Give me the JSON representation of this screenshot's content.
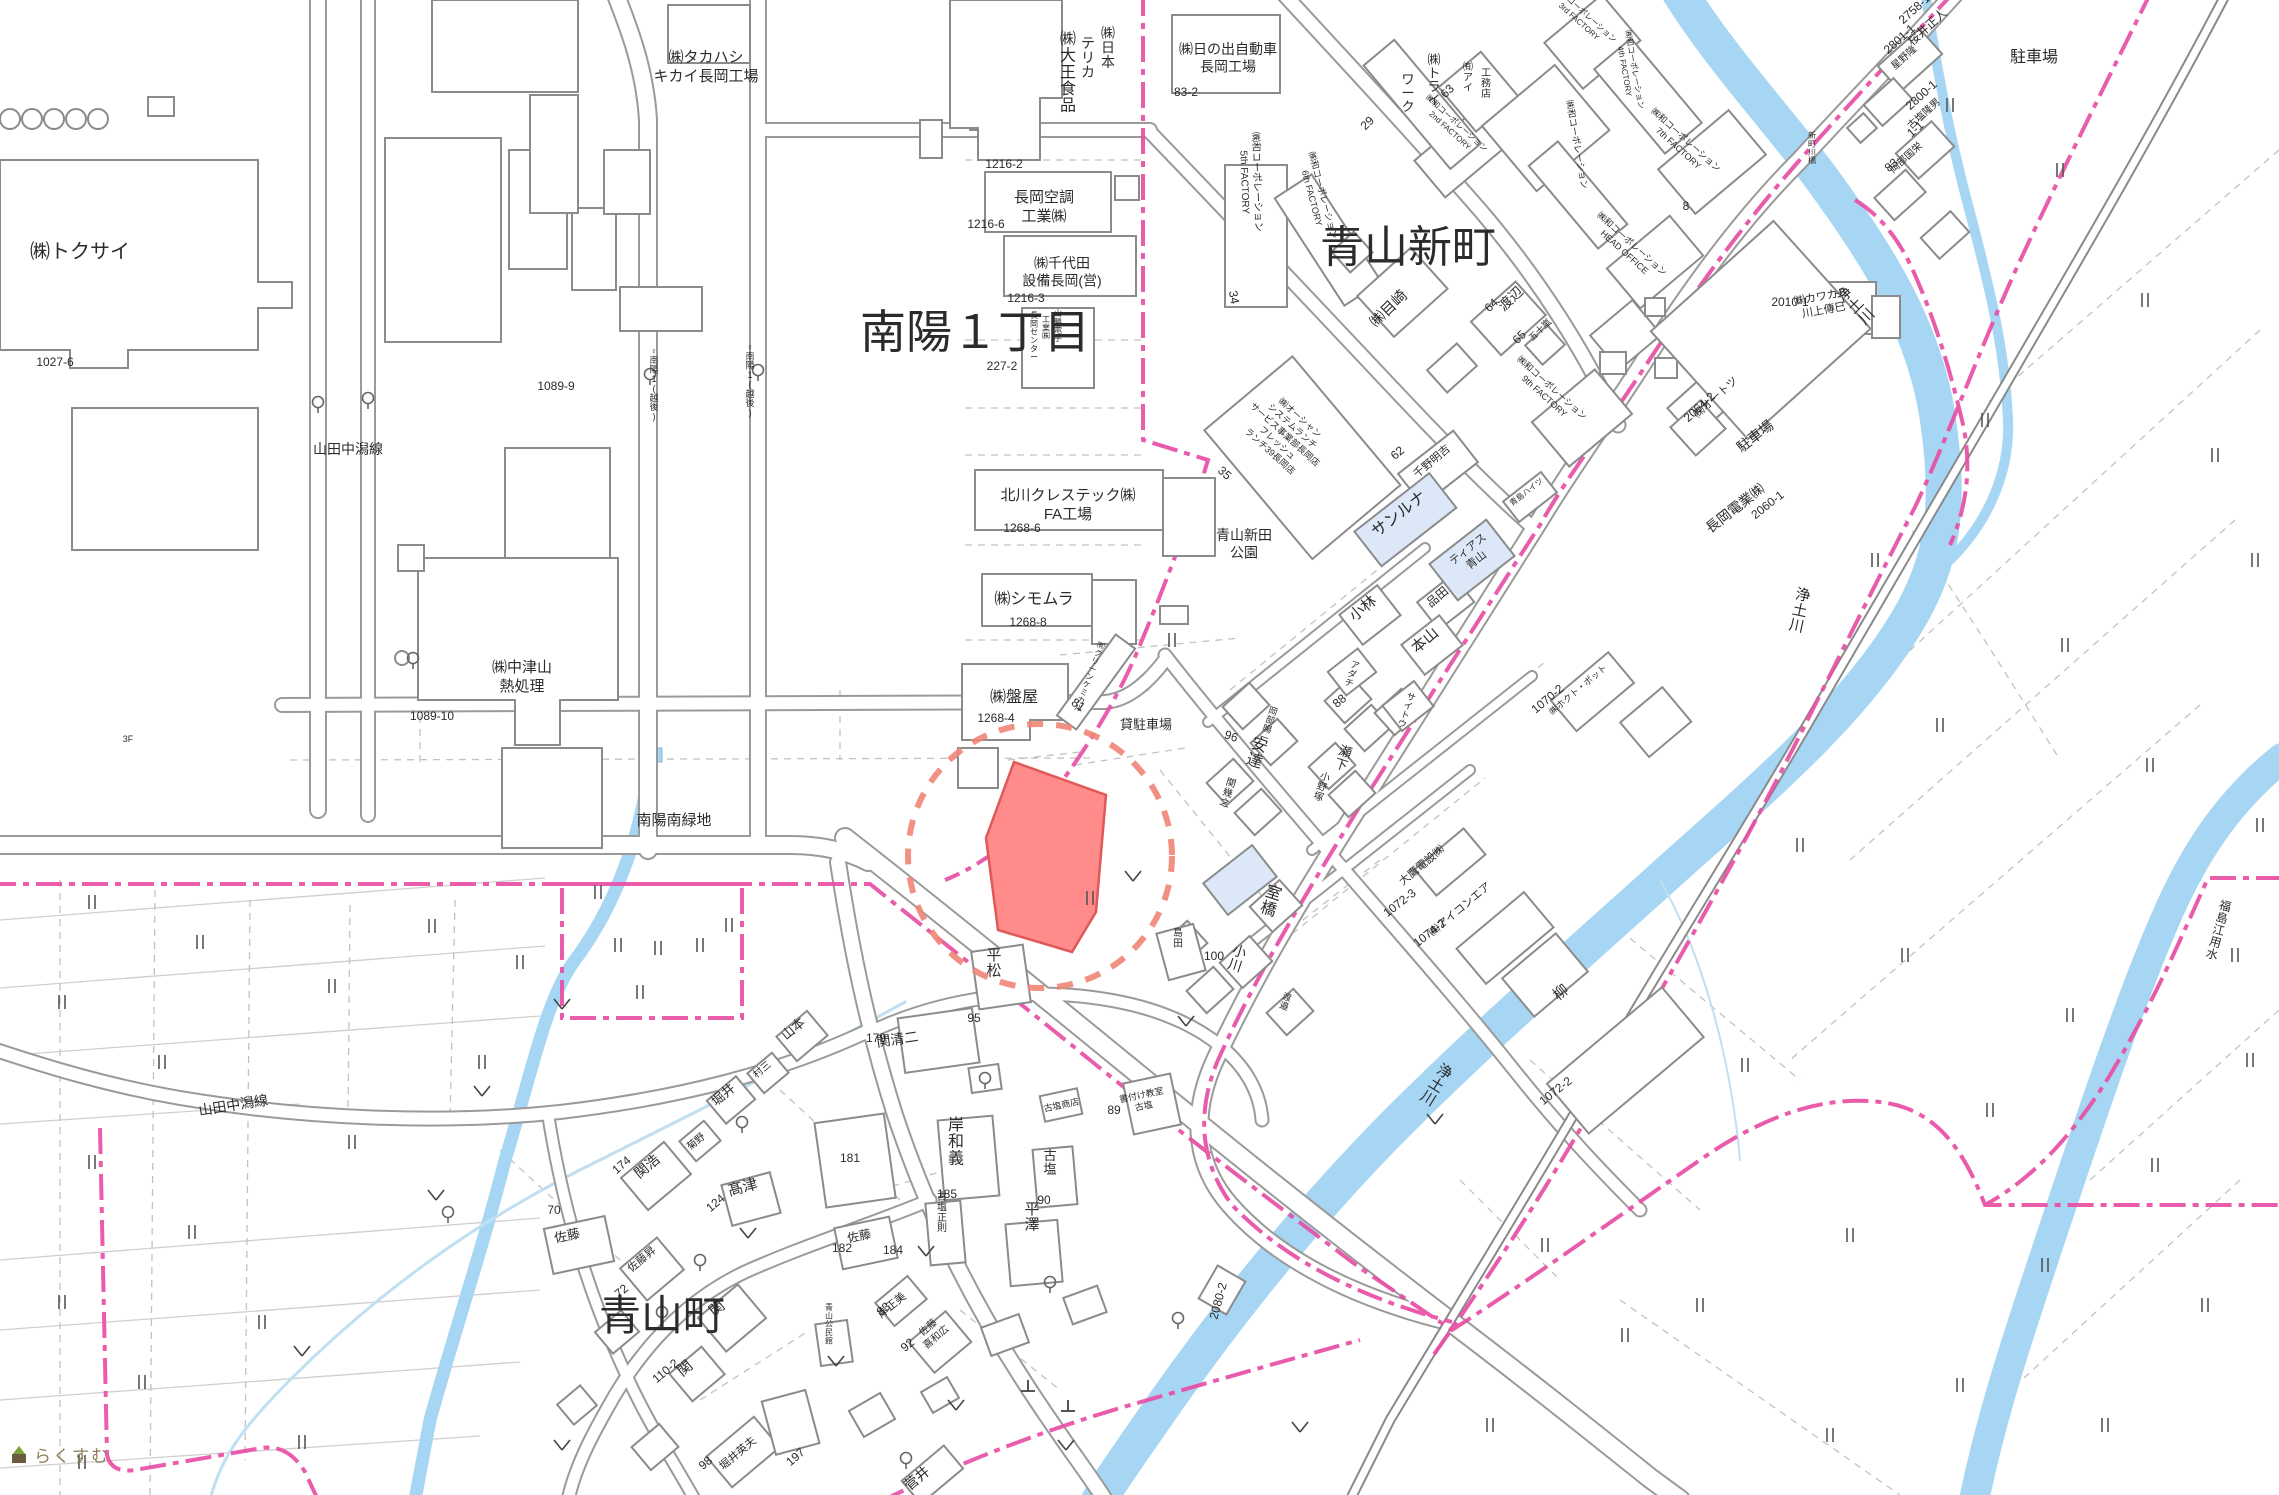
{
  "map": {
    "title": "cadastral-map-aoyama-nagaoka",
    "colors": {
      "water": "#a6d6f3",
      "water_thin": "#bfe0f2",
      "road_casing": "#9a9a9a",
      "rail": "#8a8a8a",
      "boundary_pink": "#e84fa5",
      "district_magenta": "#ee3fa7",
      "parcel_pink": "#e36db8",
      "red_parcel_fill": "#ff8b8b",
      "red_parcel_stroke": "#e05858",
      "red_circle": "#ef8576",
      "building_stroke": "#8b8b8b",
      "highlight_building": "#dce8f7"
    }
  },
  "districts": [
    {
      "text": "南陽１丁目",
      "x": 975,
      "y": 348,
      "s": 46
    },
    {
      "text": "青山新町",
      "x": 1408,
      "y": 262,
      "s": 44
    },
    {
      "text": "青山町",
      "x": 662,
      "y": 1330,
      "s": 42
    }
  ],
  "labels": [
    {
      "text": "㈱トクサイ",
      "x": 80,
      "y": 258,
      "s": 20
    },
    {
      "text": "㈱タカハシ\nキカイ長岡工場",
      "x": 706,
      "y": 62,
      "s": 15
    },
    {
      "text": "㈱日本",
      "x": 1108,
      "y": 38,
      "s": 14,
      "v": true
    },
    {
      "text": "テリカ",
      "x": 1088,
      "y": 48,
      "s": 14,
      "v": true
    },
    {
      "text": "㈱大王食品",
      "x": 1068,
      "y": 44,
      "s": 16,
      "v": true
    },
    {
      "text": "㈱日の出自動車\n長岡工場",
      "x": 1228,
      "y": 54,
      "s": 14
    },
    {
      "text": "長岡空調\n工業㈱",
      "x": 1044,
      "y": 202,
      "s": 15
    },
    {
      "text": "㈱千代田\n設備長岡(営)",
      "x": 1062,
      "y": 268,
      "s": 14
    },
    {
      "text": "山勝電子",
      "x": 1058,
      "y": 316,
      "s": 8,
      "v": true
    },
    {
      "text": "工業㈱",
      "x": 1046,
      "y": 322,
      "s": 8,
      "v": true
    },
    {
      "text": "長岡センター",
      "x": 1034,
      "y": 318,
      "s": 8,
      "v": true
    },
    {
      "text": "北川クレステック㈱\nFA工場",
      "x": 1068,
      "y": 500,
      "s": 15
    },
    {
      "text": "㈱シモムラ",
      "x": 1034,
      "y": 604,
      "s": 16
    },
    {
      "text": "㈱盤屋",
      "x": 1014,
      "y": 702,
      "s": 16
    },
    {
      "text": "㈲クリーンケミカル",
      "x": 1100,
      "y": 648,
      "s": 8,
      "v": true,
      "r": 20
    },
    {
      "text": "貸駐車場",
      "x": 1146,
      "y": 729,
      "s": 13
    },
    {
      "text": "山田中潟線",
      "x": 348,
      "y": 454,
      "s": 14
    },
    {
      "text": "山田中潟線",
      "x": 234,
      "y": 1110,
      "s": 14,
      "r": -9
    },
    {
      "text": "南陽南緑地",
      "x": 674,
      "y": 825,
      "s": 15
    },
    {
      "text": "青山新田\n公園",
      "x": 1244,
      "y": 540,
      "s": 14
    },
    {
      "text": "3F",
      "x": 128,
      "y": 742,
      "s": 9
    },
    {
      "text": "♀南陽1(越後)",
      "x": 654,
      "y": 354,
      "s": 9,
      "v": true
    },
    {
      "text": "♀南陽1(越後)",
      "x": 750,
      "y": 350,
      "s": 9,
      "v": true
    },
    {
      "text": "㈱中津山\n熱処理",
      "x": 522,
      "y": 672,
      "s": 15
    },
    {
      "text": "関清二",
      "x": 898,
      "y": 1044,
      "s": 14,
      "r": -8
    },
    {
      "text": "岸和義",
      "x": 956,
      "y": 1130,
      "s": 16,
      "v": true
    },
    {
      "text": "古塩",
      "x": 1050,
      "y": 1160,
      "s": 13,
      "v": true
    },
    {
      "text": "平澤",
      "x": 1032,
      "y": 1214,
      "s": 15,
      "v": true
    },
    {
      "text": "古塩正則",
      "x": 942,
      "y": 1200,
      "s": 10,
      "v": true
    },
    {
      "text": "岸正美",
      "x": 894,
      "y": 1308,
      "s": 11,
      "r": -40
    },
    {
      "text": "佐藤\n喜和広",
      "x": 930,
      "y": 1330,
      "s": 10,
      "r": -40
    },
    {
      "text": "古塩商店",
      "x": 1062,
      "y": 1108,
      "s": 9,
      "r": -12
    },
    {
      "text": "書付け教室\n古塩",
      "x": 1142,
      "y": 1098,
      "s": 9,
      "r": -12
    },
    {
      "text": "島田",
      "x": 1178,
      "y": 936,
      "s": 10,
      "v": true
    },
    {
      "text": "平松",
      "x": 994,
      "y": 960,
      "s": 15,
      "v": true
    },
    {
      "text": "髙津",
      "x": 744,
      "y": 1192,
      "s": 15,
      "r": -15
    },
    {
      "text": "関浩",
      "x": 650,
      "y": 1170,
      "s": 14,
      "r": -40
    },
    {
      "text": "堀井",
      "x": 726,
      "y": 1098,
      "s": 13,
      "r": -40
    },
    {
      "text": "菊野",
      "x": 698,
      "y": 1144,
      "s": 10,
      "r": -40
    },
    {
      "text": "村三",
      "x": 764,
      "y": 1072,
      "s": 10,
      "r": -40
    },
    {
      "text": "山本",
      "x": 796,
      "y": 1032,
      "s": 13,
      "r": -40
    },
    {
      "text": "佐藤",
      "x": 568,
      "y": 1240,
      "s": 13,
      "r": -12
    },
    {
      "text": "佐藤昇",
      "x": 644,
      "y": 1262,
      "s": 11,
      "r": -40
    },
    {
      "text": "関",
      "x": 720,
      "y": 1312,
      "s": 15,
      "r": -40
    },
    {
      "text": "関",
      "x": 688,
      "y": 1372,
      "s": 15,
      "r": -40
    },
    {
      "text": "青山公民館",
      "x": 829,
      "y": 1310,
      "s": 8,
      "v": true
    },
    {
      "text": "佐藤",
      "x": 860,
      "y": 1240,
      "s": 12,
      "r": -12
    },
    {
      "text": "堀井英夫",
      "x": 740,
      "y": 1456,
      "s": 11,
      "r": -40
    },
    {
      "text": "菅井",
      "x": 920,
      "y": 1482,
      "s": 14,
      "r": -40
    },
    {
      "text": "安達",
      "x": 1258,
      "y": 750,
      "s": 16,
      "v": true,
      "r": 18
    },
    {
      "text": "関幾之",
      "x": 1230,
      "y": 786,
      "s": 10,
      "v": true,
      "r": 18
    },
    {
      "text": "岡部賜一",
      "x": 1272,
      "y": 714,
      "s": 9,
      "v": true,
      "r": 18
    },
    {
      "text": "瀬下",
      "x": 1344,
      "y": 756,
      "s": 13,
      "v": true,
      "r": 18
    },
    {
      "text": "小野塚",
      "x": 1324,
      "y": 780,
      "s": 10,
      "v": true,
      "r": 18
    },
    {
      "text": "アダチ",
      "x": 1354,
      "y": 668,
      "s": 9,
      "v": true,
      "r": 18
    },
    {
      "text": "サイトウ",
      "x": 1410,
      "y": 700,
      "s": 9,
      "v": true,
      "r": 18
    },
    {
      "text": "室橋",
      "x": 1272,
      "y": 898,
      "s": 16,
      "v": true,
      "r": 18
    },
    {
      "text": "小川",
      "x": 1238,
      "y": 956,
      "s": 14,
      "v": true,
      "r": 18
    },
    {
      "text": "渡邉",
      "x": 1286,
      "y": 1000,
      "s": 9,
      "v": true,
      "r": 18
    },
    {
      "text": "小林",
      "x": 1366,
      "y": 612,
      "s": 15,
      "r": -40
    },
    {
      "text": "本山",
      "x": 1428,
      "y": 644,
      "s": 15,
      "r": -40
    },
    {
      "text": "品田",
      "x": 1440,
      "y": 600,
      "s": 12,
      "r": -40
    },
    {
      "text": "千野明吉",
      "x": 1434,
      "y": 464,
      "s": 11,
      "r": -40
    },
    {
      "text": "サンルナ",
      "x": 1402,
      "y": 518,
      "s": 16,
      "r": -38
    },
    {
      "text": "ティアス\n青山",
      "x": 1470,
      "y": 552,
      "s": 11,
      "r": -38
    },
    {
      "text": "青島ハイツ",
      "x": 1528,
      "y": 494,
      "s": 8,
      "r": -38
    },
    {
      "text": "柳",
      "x": 1564,
      "y": 996,
      "s": 15,
      "r": -40
    },
    {
      "text": "大鷹電設㈱",
      "x": 1424,
      "y": 868,
      "s": 11,
      "r": -40
    },
    {
      "text": "㈱アイコンエア",
      "x": 1462,
      "y": 912,
      "s": 11,
      "r": -40
    },
    {
      "text": "㈱目崎",
      "x": 1392,
      "y": 312,
      "s": 15,
      "r": -44
    },
    {
      "text": "渡辺",
      "x": 1514,
      "y": 302,
      "s": 14,
      "r": -44
    },
    {
      "text": "五十嵐",
      "x": 1542,
      "y": 332,
      "s": 9,
      "r": -44
    },
    {
      "text": "㈱ホクト・ポット",
      "x": 1580,
      "y": 692,
      "s": 9,
      "r": -40
    },
    {
      "text": "㈱オーシャン\nシステムランチ\nサービス事業部長岡店\nフレッシュ\nランチ39長岡店",
      "x": 1298,
      "y": 420,
      "s": 9,
      "r": 42
    },
    {
      "text": "㈱和コーポレーション\n2nd FACTORY",
      "x": 1455,
      "y": 125,
      "s": 8,
      "r": 42
    },
    {
      "text": "㈱和コーポレーション\n3rd FACTORY",
      "x": 1584,
      "y": 16,
      "s": 8,
      "r": 42
    },
    {
      "text": "㈱和コーポレーション\n4th FACTORY",
      "x": 1632,
      "y": 70,
      "s": 8,
      "r": 80
    },
    {
      "text": "㈱和コーポレーション\n5th FACTORY",
      "x": 1254,
      "y": 182,
      "s": 10,
      "r": 88
    },
    {
      "text": "㈱和コーポレーション\n6th FACTORY",
      "x": 1320,
      "y": 196,
      "s": 9,
      "r": 75
    },
    {
      "text": "㈱和コーポレーション\n7th FACTORY",
      "x": 1684,
      "y": 142,
      "s": 9,
      "r": 42
    },
    {
      "text": "㈱和コーポレーション\nHEAD OFFICE",
      "x": 1630,
      "y": 246,
      "s": 9,
      "r": 42
    },
    {
      "text": "㈱和コーポレーション\n9th FACTORY",
      "x": 1550,
      "y": 390,
      "s": 9,
      "r": 42
    },
    {
      "text": "㈱和コーポレーション",
      "x": 1574,
      "y": 145,
      "s": 9,
      "r": 80
    },
    {
      "text": "㈲アイ",
      "x": 1468,
      "y": 70,
      "s": 10,
      "v": true
    },
    {
      "text": "工務店",
      "x": 1486,
      "y": 76,
      "s": 10,
      "v": true
    },
    {
      "text": "㈱トライ",
      "x": 1434,
      "y": 64,
      "s": 13,
      "v": true
    },
    {
      "text": "ワーク",
      "x": 1408,
      "y": 84,
      "s": 13,
      "v": true
    },
    {
      "text": "桜井正人",
      "x": 1930,
      "y": 30,
      "s": 12,
      "r": -42
    },
    {
      "text": "星野隆",
      "x": 1906,
      "y": 60,
      "s": 10,
      "r": -42
    },
    {
      "text": "古塩隆男",
      "x": 1926,
      "y": 116,
      "s": 10,
      "r": -42
    },
    {
      "text": "岡部国栄",
      "x": 1908,
      "y": 160,
      "s": 10,
      "r": -42
    },
    {
      "text": "駐車場",
      "x": 2034,
      "y": 62,
      "s": 16
    },
    {
      "text": "駐車場",
      "x": 1758,
      "y": 440,
      "s": 14,
      "r": -38
    },
    {
      "text": "長岡電業㈱",
      "x": 1738,
      "y": 512,
      "s": 14,
      "r": -38
    },
    {
      "text": "㈱カワカミ\n川上傳巳",
      "x": 1822,
      "y": 300,
      "s": 11,
      "r": -10
    },
    {
      "text": "㈱オートツ",
      "x": 1718,
      "y": 400,
      "s": 11,
      "r": -42
    },
    {
      "text": "新町川橋",
      "x": 1812,
      "y": 138,
      "s": 8,
      "v": true
    },
    {
      "text": "浄土川",
      "x": 1848,
      "y": 298,
      "s": 15,
      "v": true,
      "r": -45
    },
    {
      "text": "浄土川",
      "x": 1802,
      "y": 600,
      "s": 15,
      "v": true,
      "r": 12
    },
    {
      "text": "浄土川",
      "x": 1442,
      "y": 1076,
      "s": 15,
      "v": true,
      "r": 32
    },
    {
      "text": "福島江用水",
      "x": 2224,
      "y": 910,
      "s": 12,
      "v": true,
      "r": 15
    }
  ],
  "parcels": [
    {
      "text": "1027-6",
      "x": 55,
      "y": 366
    },
    {
      "text": "1089-9",
      "x": 556,
      "y": 390
    },
    {
      "text": "1089-10",
      "x": 432,
      "y": 720
    },
    {
      "text": "1216-2",
      "x": 1004,
      "y": 168
    },
    {
      "text": "1216-6",
      "x": 986,
      "y": 228
    },
    {
      "text": "1216-3",
      "x": 1026,
      "y": 302
    },
    {
      "text": "227-2",
      "x": 1002,
      "y": 370
    },
    {
      "text": "83-2",
      "x": 1186,
      "y": 96
    },
    {
      "text": "1268-6",
      "x": 1022,
      "y": 532
    },
    {
      "text": "1268-8",
      "x": 1028,
      "y": 626
    },
    {
      "text": "1268-4",
      "x": 996,
      "y": 722
    },
    {
      "text": "81",
      "x": 1076,
      "y": 708,
      "r": 35
    },
    {
      "text": "110-2",
      "x": 668,
      "y": 1374,
      "r": -40
    },
    {
      "text": "98",
      "x": 708,
      "y": 1466,
      "r": -40
    },
    {
      "text": "197",
      "x": 798,
      "y": 1460,
      "r": -40
    },
    {
      "text": "185",
      "x": 947,
      "y": 1198
    },
    {
      "text": "174",
      "x": 624,
      "y": 1168,
      "r": -40
    },
    {
      "text": "124",
      "x": 718,
      "y": 1206,
      "r": -40
    },
    {
      "text": "179",
      "x": 876,
      "y": 1042
    },
    {
      "text": "181",
      "x": 850,
      "y": 1162
    },
    {
      "text": "83",
      "x": 886,
      "y": 1312,
      "r": -40
    },
    {
      "text": "92",
      "x": 910,
      "y": 1348,
      "r": -40
    },
    {
      "text": "70",
      "x": 554,
      "y": 1214
    },
    {
      "text": "182",
      "x": 842,
      "y": 1252
    },
    {
      "text": "184",
      "x": 893,
      "y": 1254
    },
    {
      "text": "72",
      "x": 624,
      "y": 1294,
      "r": -40
    },
    {
      "text": "100",
      "x": 1214,
      "y": 960
    },
    {
      "text": "95",
      "x": 974,
      "y": 1022
    },
    {
      "text": "90",
      "x": 1044,
      "y": 1204
    },
    {
      "text": "89",
      "x": 1114,
      "y": 1114
    },
    {
      "text": "96",
      "x": 1230,
      "y": 740,
      "r": 18
    },
    {
      "text": "88",
      "x": 1342,
      "y": 704,
      "r": -40
    },
    {
      "text": "62",
      "x": 1400,
      "y": 456,
      "r": -40
    },
    {
      "text": "64",
      "x": 1494,
      "y": 308,
      "r": -44
    },
    {
      "text": "65",
      "x": 1522,
      "y": 340,
      "r": -44
    },
    {
      "text": "63",
      "x": 1450,
      "y": 94,
      "r": -44
    },
    {
      "text": "29",
      "x": 1370,
      "y": 126,
      "r": -44
    },
    {
      "text": "34",
      "x": 1230,
      "y": 298,
      "r": 80
    },
    {
      "text": "35",
      "x": 1222,
      "y": 476,
      "r": 42
    },
    {
      "text": "8",
      "x": 1686,
      "y": 210
    },
    {
      "text": "2060-1",
      "x": 1770,
      "y": 508,
      "r": -38
    },
    {
      "text": "1070-2",
      "x": 1550,
      "y": 702,
      "r": -40
    },
    {
      "text": "1072-2",
      "x": 1558,
      "y": 1094,
      "r": -38
    },
    {
      "text": "1072-3",
      "x": 1402,
      "y": 906,
      "r": -38
    },
    {
      "text": "1074-2",
      "x": 1432,
      "y": 936,
      "r": -38
    },
    {
      "text": "2801-1",
      "x": 1902,
      "y": 42,
      "r": -42
    },
    {
      "text": "2758-1",
      "x": 1917,
      "y": 12,
      "r": -42
    },
    {
      "text": "2800-1",
      "x": 1924,
      "y": 98,
      "r": -42
    },
    {
      "text": "1-1",
      "x": 1918,
      "y": 132,
      "r": -42
    },
    {
      "text": "83",
      "x": 1894,
      "y": 168,
      "r": -42
    },
    {
      "text": "2064-2",
      "x": 1702,
      "y": 410,
      "r": -42
    },
    {
      "text": "2010-1",
      "x": 1790,
      "y": 306
    },
    {
      "text": "2080-2",
      "x": 1222,
      "y": 1302,
      "r": -75
    }
  ],
  "symbols": {
    "paddy": [
      [
        729,
        925
      ],
      [
        658,
        948
      ],
      [
        598,
        892
      ],
      [
        640,
        992
      ],
      [
        520,
        962
      ],
      [
        432,
        926
      ],
      [
        332,
        986
      ],
      [
        200,
        942
      ],
      [
        92,
        902
      ],
      [
        62,
        1002
      ],
      [
        162,
        1062
      ],
      [
        92,
        1162
      ],
      [
        192,
        1232
      ],
      [
        62,
        1302
      ],
      [
        142,
        1382
      ],
      [
        82,
        1462
      ],
      [
        262,
        1322
      ],
      [
        352,
        1142
      ],
      [
        302,
        1442
      ],
      [
        482,
        1062
      ],
      [
        618,
        945
      ],
      [
        700,
        945
      ],
      [
        1172,
        640
      ],
      [
        1950,
        105
      ],
      [
        2060,
        170
      ],
      [
        2145,
        300
      ],
      [
        1985,
        420
      ],
      [
        2215,
        455
      ],
      [
        2255,
        560
      ],
      [
        1875,
        560
      ],
      [
        2065,
        645
      ],
      [
        1940,
        725
      ],
      [
        2150,
        765
      ],
      [
        2260,
        825
      ],
      [
        1800,
        845
      ],
      [
        1905,
        955
      ],
      [
        2235,
        955
      ],
      [
        2070,
        1015
      ],
      [
        1745,
        1065
      ],
      [
        1990,
        1110
      ],
      [
        2155,
        1165
      ],
      [
        2045,
        1265
      ],
      [
        1850,
        1235
      ],
      [
        1700,
        1305
      ],
      [
        2205,
        1305
      ],
      [
        1960,
        1385
      ],
      [
        2105,
        1425
      ],
      [
        1830,
        1435
      ],
      [
        1545,
        1245
      ],
      [
        1625,
        1335
      ],
      [
        1490,
        1425
      ],
      [
        2250,
        1060
      ],
      [
        1090,
        898
      ]
    ],
    "checks": [
      [
        562,
        1005
      ],
      [
        482,
        1092
      ],
      [
        436,
        1196
      ],
      [
        302,
        1352
      ],
      [
        562,
        1446
      ],
      [
        836,
        1362
      ],
      [
        956,
        1406
      ],
      [
        1066,
        1446
      ],
      [
        926,
        1252
      ],
      [
        1133,
        877
      ],
      [
        1186,
        1022
      ],
      [
        1300,
        1428
      ],
      [
        748,
        1234
      ],
      [
        1435,
        1120
      ]
    ],
    "stops": [
      [
        742,
        1122
      ],
      [
        700,
        1260
      ],
      [
        906,
        1458
      ],
      [
        1050,
        1282
      ],
      [
        985,
        1078
      ],
      [
        448,
        1212
      ],
      [
        1178,
        1318
      ],
      [
        662,
        1312
      ],
      [
        318,
        402
      ],
      [
        368,
        398
      ],
      [
        650,
        374
      ],
      [
        758,
        370
      ],
      [
        413,
        658
      ]
    ],
    "posts": [
      [
        1028,
        1386
      ],
      [
        1068,
        1406
      ]
    ]
  },
  "watermark": {
    "text": "らくすむ"
  }
}
